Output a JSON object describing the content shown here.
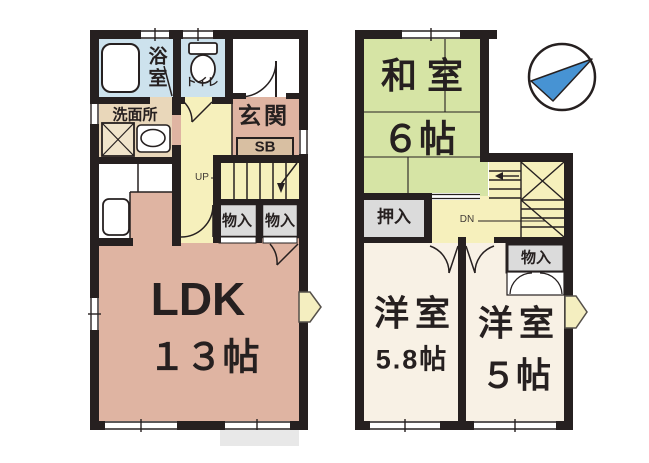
{
  "floorplan": {
    "f1": {
      "bath": "浴室",
      "toilet": "トイレ",
      "washroom": "洗面所",
      "entrance": "玄関",
      "shoe_box": "SB",
      "stairs_up": "UP",
      "storage_a": "物入",
      "storage_b": "物入",
      "ldk": "LDK",
      "ldk_size": "１３帖"
    },
    "f2": {
      "japanese_room": "和室",
      "japanese_room_size": "６帖",
      "closet": "押入",
      "stairs_down": "DN",
      "storage": "物入",
      "western_room_a": "洋室",
      "western_room_a_size": "5.8帖",
      "western_room_b": "洋室",
      "western_room_b_size": "５帖"
    },
    "colors": {
      "wall": "#262020",
      "ldk_pink": "#dfb4a2",
      "hall_yellow": "#f6f0bc",
      "wet_blue": "#cde2ed",
      "washroom_tan": "#e9d7ba",
      "shoebox_tan": "#d8bfa2",
      "storage_gray": "#dbdbdb",
      "tatami_green": "#d6e4a5",
      "western_cream": "#f8f1e5",
      "porch_gray": "#e8e8e8",
      "arrow_yellow": "#f4eec0",
      "compass_blue": "#4793d3"
    }
  }
}
